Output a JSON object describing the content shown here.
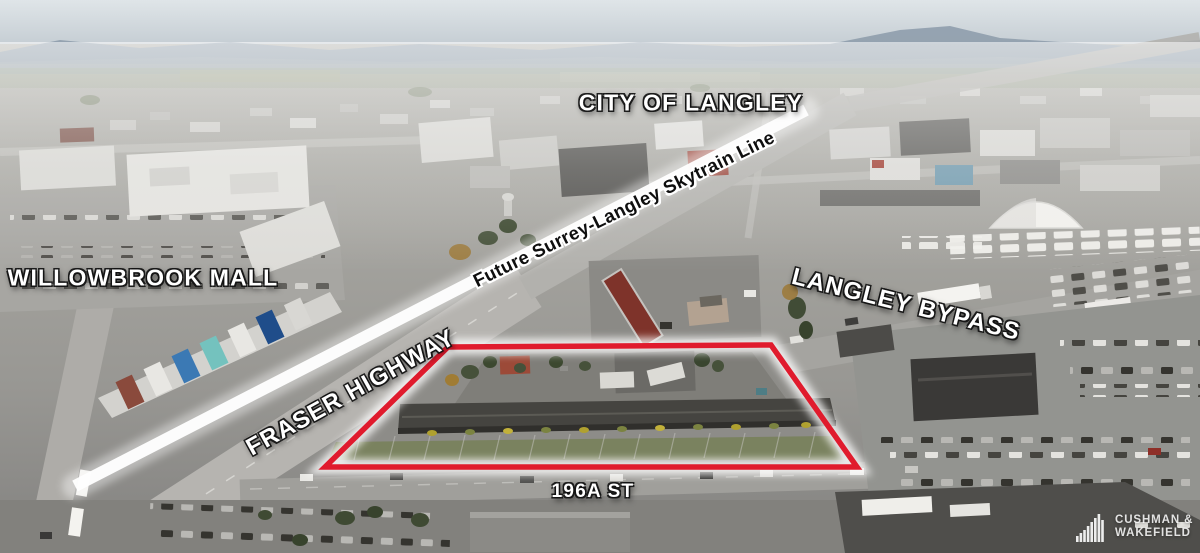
{
  "scene": {
    "description": "Drone aerial photograph of a commercial strip-mall property outlined in red at the corner of Fraser Highway and 196A St, with surrounding retail district, car dealerships and distant mountains under a hazy sky"
  },
  "annotations": {
    "city_label": "CITY OF LANGLEY",
    "mall_label": "WILLOWBROOK MALL",
    "skytrain_label": "Future Surrey-Langley Skytrain Line",
    "bypass_label": "LANGLEY BYPASS",
    "highway_label": "FRASER HIGHWAY",
    "street_label": "196A ST"
  },
  "branding": {
    "name_line1": "CUSHMAN &",
    "name_line2": "WAKEFIELD",
    "icon": "bar-chart-logo-icon"
  },
  "colors": {
    "highlight_red": "#e01b2d",
    "overlay_white": "#ffffff",
    "skytrain_text": "#0e0e0e"
  }
}
